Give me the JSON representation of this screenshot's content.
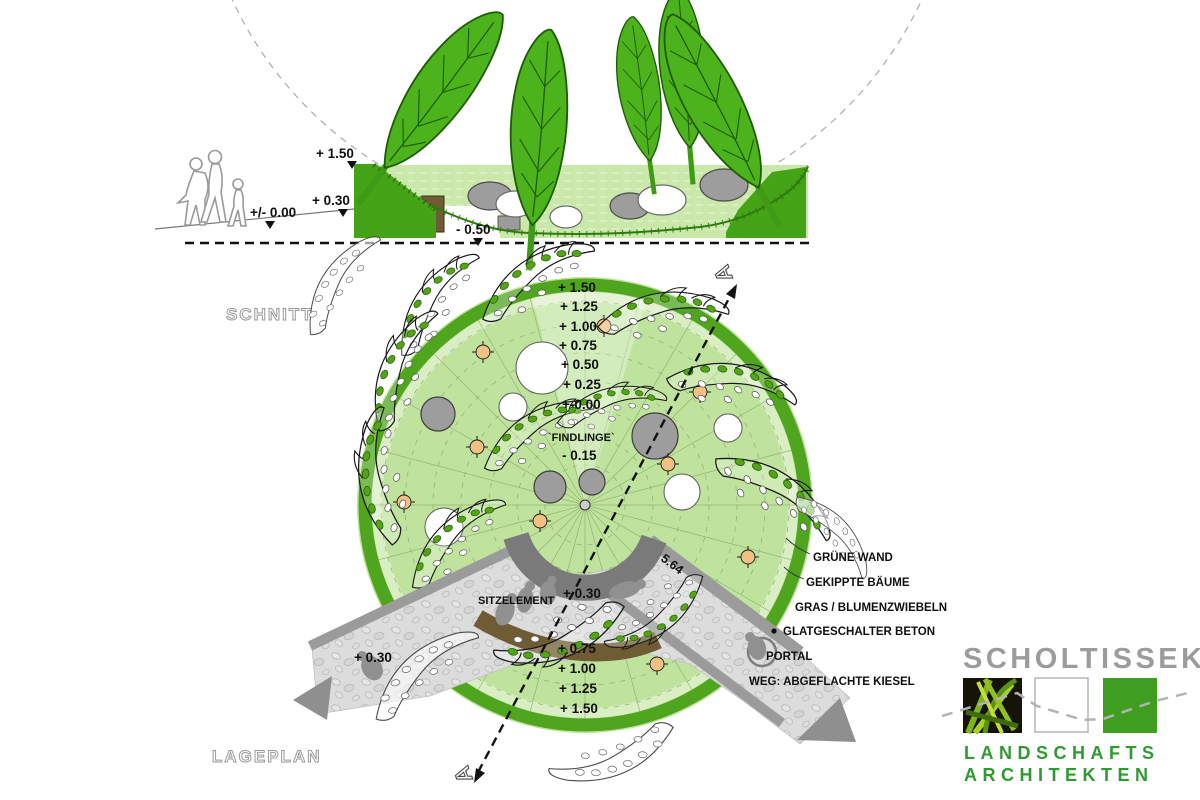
{
  "section": {
    "title": "SCHNITT",
    "level_150": "+ 1.50",
    "level_030": "+ 0.30",
    "level_000": "+/- 0.00",
    "level_m050": "- 0.50"
  },
  "plan": {
    "title": "LAGEPLAN",
    "section_marker": "A",
    "elevations_top": [
      "+ 1.50",
      "+ 1.25",
      "+ 1.00",
      "+ 0.75",
      "+ 0.50",
      "+ 0.25",
      "+-0.00"
    ],
    "findlinge_label": "`FINDLINGE`",
    "findlinge_level": "- 0.15",
    "elevations_bottom": [
      "+ 0.75",
      "+ 1.00",
      "+ 1.25",
      "+ 1.50"
    ],
    "path_level_center": "+ 0.30",
    "path_level_left": "+ 0.30",
    "path_width_dimension": "5.64",
    "seat_label": "SITZELEMENT",
    "callouts": [
      "GRÜNE WAND",
      "GEKIPPTE BÄUME",
      "GRAS / BLUMENZWIEBELN",
      "GLATGESCHALTER BETON",
      "PORTAL",
      "WEG: ABGEFLACHTE KIESEL"
    ]
  },
  "logo": {
    "firm": "SCHOLTISSEK",
    "sub1": "LANDSCHAFTS",
    "sub2": "ARCHITEKTEN"
  },
  "colors": {
    "bright_green": "#4cb31d",
    "rim_green": "#4fa51d",
    "light_green": "#bfe39c",
    "dark_gray_wall": "#7a7a7a",
    "concrete_gray": "#9b9b9b",
    "gravel_gray": "#dcdcdc",
    "seat_brown": "#6f5c35",
    "tree_post_orange": "#f0c183",
    "logo_green": "#3f9e1f",
    "logo_gray": "#9c9c9c"
  }
}
